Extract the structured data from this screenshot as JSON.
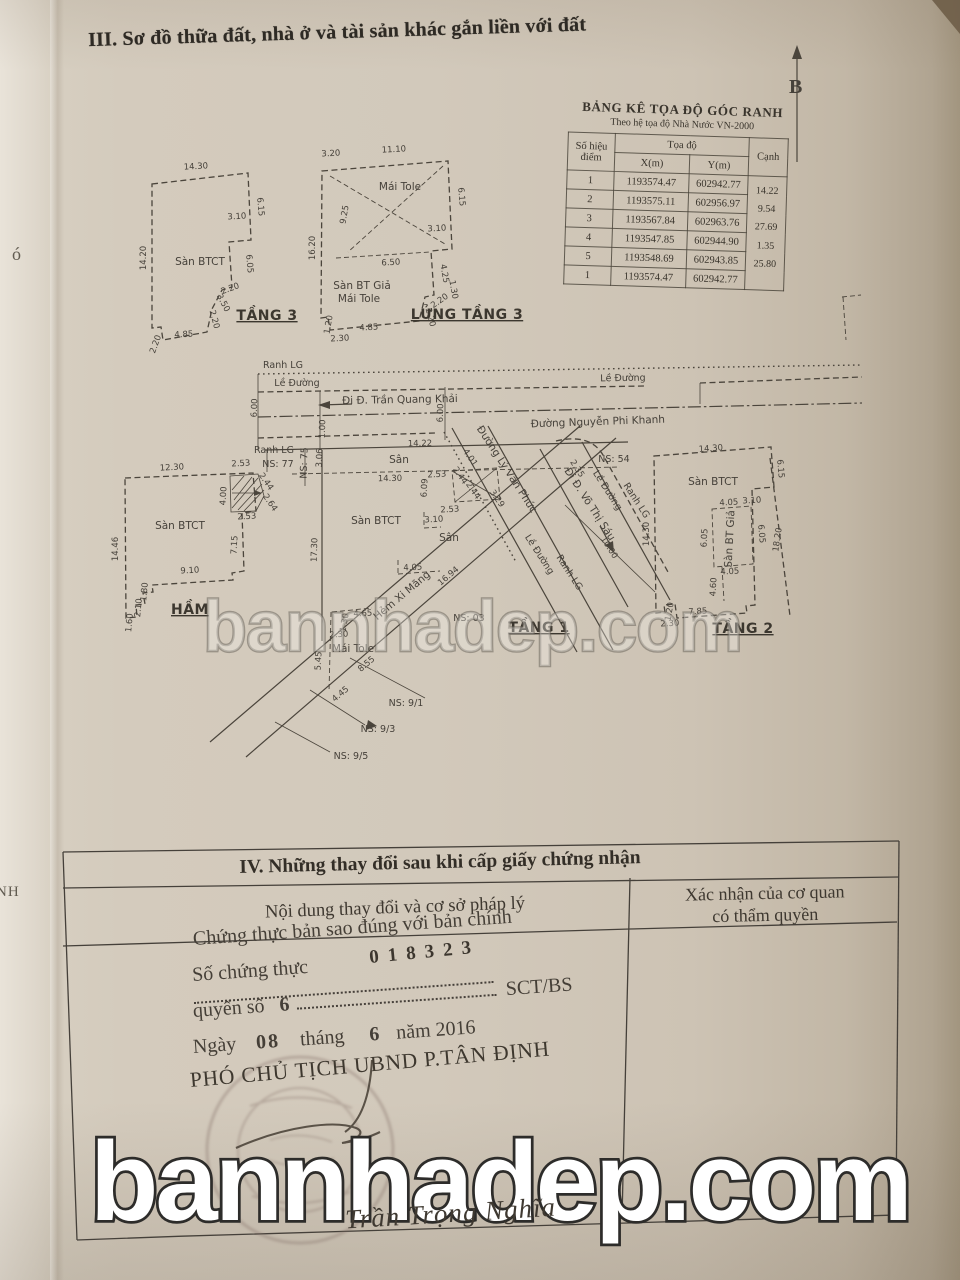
{
  "doc": {
    "section3_title": "III. Sơ đồ thữa đất, nhà ở và tài sản khác gắn liền với đất",
    "north": "B",
    "bleed_left1": "ó",
    "bleed_left2": "NH",
    "watermark": "bannhadep.com"
  },
  "coord_table": {
    "title": "BẢNG KÊ TỌA ĐỘ GÓC RANH",
    "subtitle": "Theo hệ tọa độ Nhà Nước VN-2000",
    "col_point": "Số hiệu điểm",
    "col_coord": "Tọa độ",
    "col_x": "X(m)",
    "col_y": "Y(m)",
    "col_edge": "Cạnh",
    "rows": [
      {
        "pt": "1",
        "x": "1193574.47",
        "y": "602942.77",
        "edge": ""
      },
      {
        "pt": "2",
        "x": "1193575.11",
        "y": "602956.97",
        "edge": "14.22"
      },
      {
        "pt": "3",
        "x": "1193567.84",
        "y": "602963.76",
        "edge": "9.54"
      },
      {
        "pt": "4",
        "x": "1193547.85",
        "y": "602944.90",
        "edge": "27.69"
      },
      {
        "pt": "5",
        "x": "1193548.69",
        "y": "602943.85",
        "edge": "1.35"
      },
      {
        "pt": "1",
        "x": "1193574.47",
        "y": "602942.77",
        "edge": "25.80"
      }
    ]
  },
  "t3": {
    "name": "TẦNG 3",
    "san": "Sàn BTCT",
    "dims": [
      "14.30",
      "6.15",
      "3.10",
      "6.05",
      "2.20",
      "3.50",
      "2.20",
      "4.85",
      "2.20",
      "14.20"
    ]
  },
  "l3": {
    "name": "LỬNG TẦNG 3",
    "mai": "Mái Tole",
    "san1": "Sàn BT Giả",
    "san2": "Mái Tole",
    "dims": [
      "3.20",
      "11.10",
      "6.15",
      "9.25",
      "3.10",
      "4.25",
      "6.50",
      "1.30",
      "2.20",
      "2.20",
      "4.85",
      "1.20",
      "2.30",
      "16.20"
    ]
  },
  "ham": {
    "name": "HẦM",
    "san": "Sàn BTCT",
    "dims": [
      "12.30",
      "2.53",
      "2.44",
      "4.00",
      "2.64",
      "2.53",
      "7.15",
      "9.10",
      "1.80",
      "2.10",
      "1.60",
      "14.46"
    ]
  },
  "t1": {
    "name": "TẦNG 1",
    "san_btct": "Sàn BTCT",
    "san": "Sân",
    "mai": "Mái Tole",
    "hem": "Hẻm Xi Măng",
    "ns03": "NS: 03",
    "ns91": "NS: 9/1",
    "ns93": "NS: 9/3",
    "ns95": "NS: 9/5",
    "dims": [
      "4.01",
      "2.53",
      "2.44",
      "2.44",
      "3.29",
      "6.09",
      "2.53",
      "3.10",
      "4.05",
      "16.94",
      "8.55",
      "5.45",
      "2.30",
      "4.65",
      "1.30",
      "4.45",
      "10.00",
      "2.35"
    ]
  },
  "t2": {
    "name": "TẦNG 2",
    "san_btct": "Sàn BTCT",
    "san_gia": "Sàn BT Giả",
    "dims": [
      "14.30",
      "6.15",
      "3.10",
      "4.05",
      "6.05",
      "6.05",
      "4.05",
      "4.60",
      "7.85",
      "1.20",
      "2.30",
      "14.30",
      "18.20"
    ]
  },
  "site": {
    "ranh_lg": "Ranh LG",
    "le_duong": "Lề Đường",
    "road_tqk": "Đi Đ. Trần Quang Khải",
    "road_npk": "Đường Nguyễn Phi Khanh",
    "road_lvp": "Đường Lý Văn Phức",
    "road_vts": "Đi Đ. Võ Thị Sáu",
    "ns77": "NS: 77",
    "ns75": "NS: 75",
    "ns54": "NS: 54",
    "san": "Sân",
    "dims": [
      "14.22",
      "14.30",
      "3.06",
      "6.00",
      "6.00",
      "1.00",
      "17.30"
    ]
  },
  "s4": {
    "title": "IV. Những thay đổi sau khi cấp giấy chứng nhận",
    "col_left": "Nội dung thay đổi và cơ sở pháp lý",
    "col_right1": "Xác nhận của cơ quan",
    "col_right2": "có thẩm quyền",
    "line1": "Chứng thực bản sao đúng với bản chính",
    "line2_label": "Số chứng thực",
    "line2_number": "018323",
    "line3_label": "quyển số",
    "line3_value": "6",
    "line3_suffix": "SCT/BS",
    "line4_ngay": "Ngày",
    "line4_d": "08",
    "line4_thang": "tháng",
    "line4_m": "6",
    "line4_nam": "năm 2016",
    "line5": "PHÓ CHỦ TỊCH UBND P.TÂN ĐỊNH",
    "signature": "Trần Trọng Nghĩa"
  }
}
